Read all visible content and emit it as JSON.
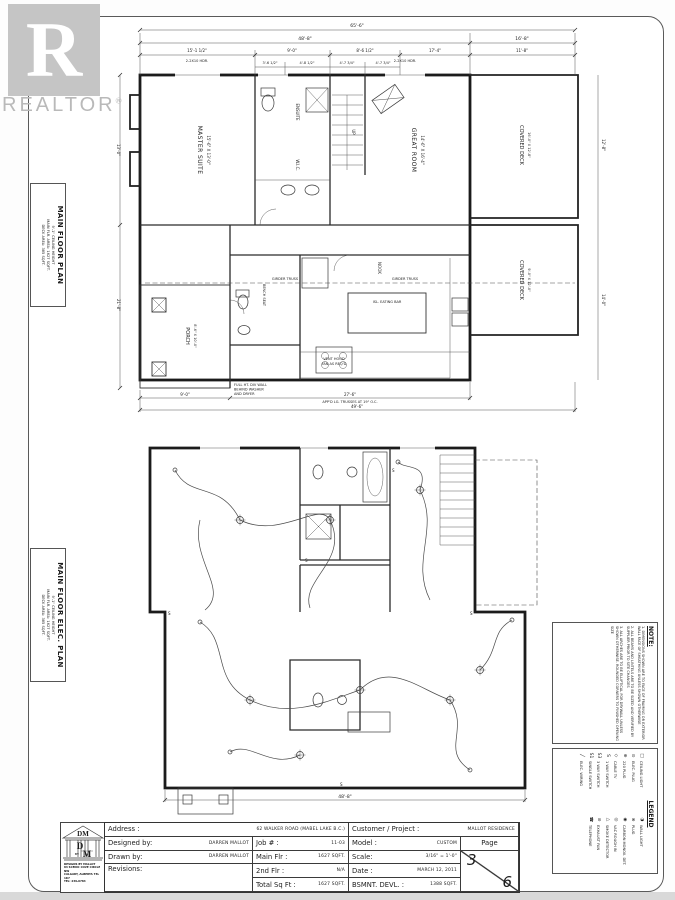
{
  "watermark": {
    "r": "R",
    "brand": "REALTOR",
    "reg": "®"
  },
  "side_labels": {
    "plan": {
      "l1": "MAIN FLOOR PLAN",
      "l2": "9'-1\" CEILING HEIGHT",
      "l3": "MAIN FLR. AREA: 1627 SQFT.",
      "l4": "DECK AREA: 385 SQFT."
    },
    "elec": {
      "l1": "MAIN FLOOR ELEC. PLAN",
      "l2": "9'-1\" CEILING HEIGHT",
      "l3": "MAIN FLR. AREA: 1627 SQFT.",
      "l4": "DECK AREA: 385 SQFT."
    }
  },
  "note": {
    "title": "NOTE:",
    "items": [
      "1. DIMENSIONS SHOWN ARE TO FACE OF FRAMING OR EXTERIOR WALL FACE OF SHEATHING UNLESS SHOWN OTHERWISE",
      "2. ALL BEAMS AND LINTELS ARE TO BE SIZED AND VERIFIED BY SUPPLIER PRIOR TO SITE CHANGES",
      "3. ALL ARCHES ARE TO BE ELLIPTICAL FOR DRYWALL UNLESS SHOWN OTHERWISE. ROUNDED CORNERS TO FINISHED OPENING SIZE"
    ]
  },
  "legend": {
    "title": "LEGEND",
    "col1": [
      {
        "sym": "□",
        "label": "CEILING LIGHT"
      },
      {
        "sym": "⊙",
        "label": "ELEC. PLUG"
      },
      {
        "sym": "⊕",
        "label": "220 PLUG"
      },
      {
        "sym": "◇",
        "label": "CABLE TV"
      },
      {
        "sym": "S",
        "label": "1 WAY SWITCH"
      },
      {
        "sym": "S3",
        "label": "3 WAY SWITCH"
      },
      {
        "sym": "S1",
        "label": "SINGLE SWITCH"
      },
      {
        "sym": "╱",
        "label": "ELEC. WIRING"
      }
    ],
    "col2": [
      {
        "sym": "◑",
        "label": "WALL LIGHT"
      },
      {
        "sym": "⊗",
        "label": "PLUG"
      },
      {
        "sym": "◉",
        "label": "CARBON MONOX. DET."
      },
      {
        "sym": "◎",
        "label": "VAC ROUGH IN"
      },
      {
        "sym": "△",
        "label": "SMOKE DETECTOR"
      },
      {
        "sym": "⊘",
        "label": "EXHAUST FAN"
      },
      {
        "sym": "☎",
        "label": "TELEPHONE"
      }
    ]
  },
  "logo": {
    "monogram": "DM",
    "d": "D",
    "by": "BY",
    "m": "M",
    "line1": "DESIGNS BY MALLOT",
    "line2": "84 SCENIC COVE CIRCLE NW",
    "line3": "CALGARY, ALBERTA T3L 1K7",
    "line4": "TEL: 239-0784"
  },
  "title_block": {
    "address_label": "Address :",
    "address_value": "62 WALKER ROAD (MABEL LAKE B.C.)",
    "customer_label": "Customer / Project :",
    "customer_value": "MALLOT RESIDENCE",
    "designed_label": "Designed by:",
    "designed_value": "DARREN MALLOT",
    "job_label": "Job # :",
    "job_value": "11-03",
    "model_label": "Model :",
    "model_value": "CUSTOM",
    "page_label": "Page",
    "drawn_label": "Drawn by:",
    "drawn_value": "DARREN MALLOT",
    "mainflr_label": "Main Flr :",
    "mainflr_value": "1627 SQFT.",
    "scale_label": "Scale:",
    "scale_value": "3/16\" = 1'-0\"",
    "revisions_label": "Revisions:",
    "secondflr_label": "2nd Flr :",
    "secondflr_value": "N/A",
    "date_label": "Date :",
    "date_value": "MARCH 12, 2011",
    "total_label": "Total Sq Ft :",
    "total_value": "1627 SQFT.",
    "bsmnt_label": "BSMNT. DEVL. :",
    "bsmnt_value": "1388 SQFT.",
    "page_num": "3",
    "page_den": "6"
  },
  "plan_top": {
    "labels": {
      "master": "MASTER SUITE",
      "master_dims": "15'-6\" X 13'-0\"",
      "ensuite": "ENSUITE",
      "wic": "W.I.C.",
      "great": "GREAT ROOM",
      "great_dims": "14'-6\" X 16'-4\"",
      "deck1": "COVERED DECK",
      "deck1_dims": "16'-0\" X 12'-8\"",
      "deck2": "COVERED DECK",
      "deck2_dims": "9'-0\" X 12'-0\"",
      "porch": "PORCH",
      "porch_dims": "8'-6\" X 10'-0\"",
      "nook": "NOOK",
      "island": "ISL. EATING BAR",
      "bench": "BENCH SEAT",
      "girder": "GIRDER TRUSS",
      "vent1": "VENT HOOD",
      "vent2": "FAN AS REQ'D",
      "div1": "FULL HT. DIV WALL",
      "div2": "BEHIND WASHER",
      "div3": "AND DRYER",
      "truss": "APP'D LG. TRUSSES AT 19\" O.C.",
      "up": "UP",
      "hdr": "2-2X10 HDR."
    },
    "dims": {
      "overall": "65'-6\"",
      "main": "48'-8\"",
      "deck": "16'-8\"",
      "a": "15'-1 1/2\"",
      "b": "9'-0\"",
      "c": "8'-6 1/2\"",
      "d": "17'-4\"",
      "e": "11'-8\"",
      "f": "3'-6 1/2\"",
      "g": "4'-8 1/2\"",
      "h": "4'-7 3/4\"",
      "i": "4'-7 3/4\"",
      "left1": "13'-0\"",
      "left2": "21'-8\"",
      "right1": "12'-8\"",
      "right2": "14'-0\"",
      "bot1": "9'-0\"",
      "bot2": "27'-6\"",
      "bot3": "49'-6\""
    }
  },
  "plan_bottom": {
    "dims": {
      "bottom": "48'-8\""
    },
    "sw": "S"
  }
}
